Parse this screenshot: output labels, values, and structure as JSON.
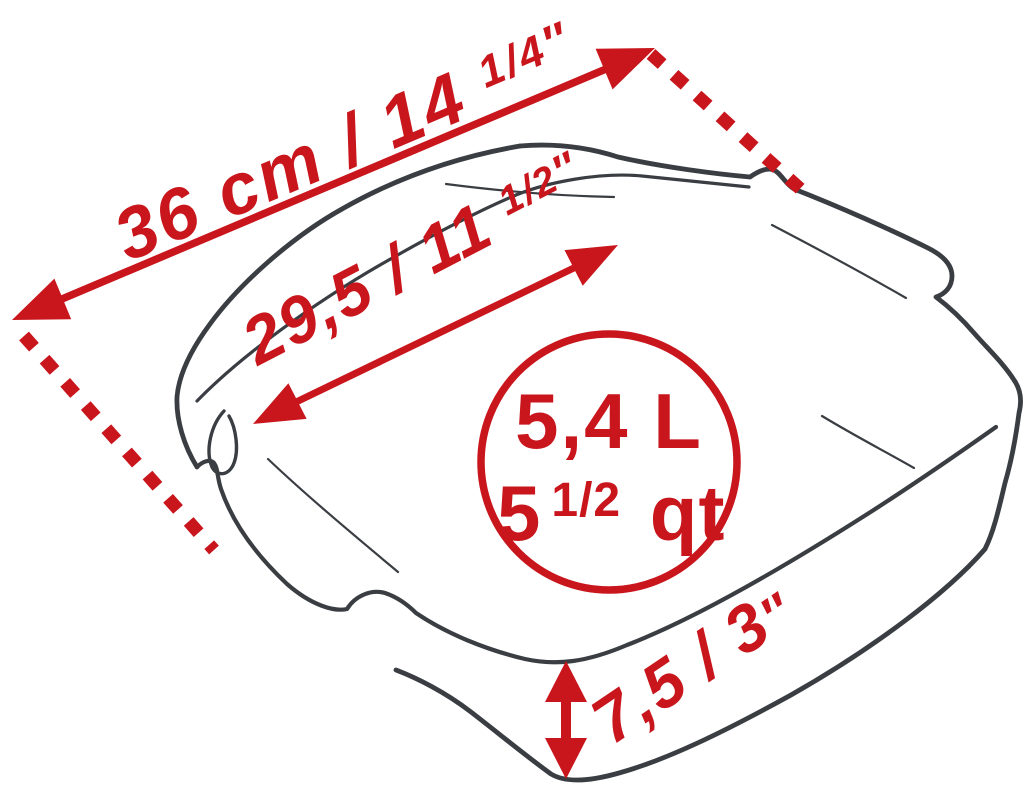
{
  "diagram": {
    "description": "Square baking dish dimension diagram",
    "labels": {
      "diagonal": {
        "main": "36 cm / 14 ",
        "frac": "1/4",
        "unit": "″"
      },
      "inner_width": {
        "main": "29,5 / 11 ",
        "frac": "1/2",
        "unit": "″"
      },
      "height": {
        "main": "7,5 / 3",
        "unit": "″"
      },
      "capacity": {
        "line1": "5,4 L",
        "line2_value": "5",
        "line2_frac": "1/2",
        "line2_unit": " qt"
      }
    },
    "colors": {
      "red": "#c9151c",
      "dark": "#3a3e43",
      "background": "#ffffff"
    }
  }
}
